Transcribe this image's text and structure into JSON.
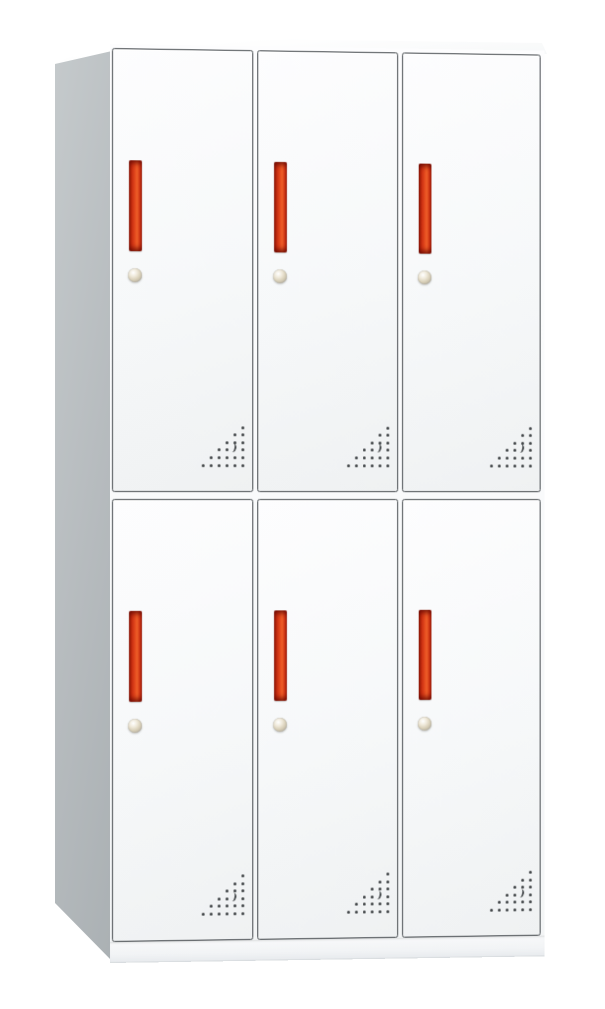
{
  "scene": {
    "description": "Product photograph of a white six-door steel locker cabinet on a plain white background, viewed slightly from the front-left so the grey left side panel and white top slab are visible.",
    "background_color": "#ffffff",
    "contains_text": false
  },
  "cabinet": {
    "type": "six-door-metal-locker",
    "rows": 2,
    "columns": 3,
    "door_count": 6,
    "doors": [
      {
        "id": "door-top-left",
        "row": 1,
        "column": 1
      },
      {
        "id": "door-top-center",
        "row": 1,
        "column": 2
      },
      {
        "id": "door-top-right",
        "row": 1,
        "column": 3
      },
      {
        "id": "door-bottom-left",
        "row": 2,
        "column": 1
      },
      {
        "id": "door-bottom-center",
        "row": 2,
        "column": 2
      },
      {
        "id": "door-bottom-right",
        "row": 2,
        "column": 3
      }
    ],
    "door_features": {
      "handle": {
        "shape": "vertical-recessed-bar",
        "color": "#e04518",
        "position": "upper-left-of-door"
      },
      "lock": {
        "shape": "round-cam-lock",
        "color": "#d9d0b9",
        "position": "below-handle"
      },
      "vent": {
        "shape": "triangular-dot-grid-with-crescent-cutout",
        "color": "#3d4144",
        "position": "bottom-right-of-door"
      }
    }
  },
  "vent_pattern": {
    "rows": 6,
    "dots_per_row": [
      1,
      2,
      3,
      4,
      5,
      6
    ],
    "alignment": "right-aligned-triangle",
    "spacing_x": 8,
    "spacing_y": 7.6,
    "dot_size": 3,
    "crescent": {
      "row_index": 3,
      "from_right": 1
    }
  },
  "colors": {
    "background": "#ffffff",
    "front_face": "#fafbfc",
    "door_face_light": "#fdfdfe",
    "door_face_dark": "#eff1f2",
    "door_border": "#43484c",
    "side_panel_light": "#c5cacc",
    "side_panel_dark": "#aab0b3",
    "top_surface_light": "#ffffff",
    "top_surface_dark": "#edf0f1",
    "handle_red_dark": "#8e1708",
    "handle_red_mid": "#c62c10",
    "handle_red_bright": "#ee5f28",
    "lock_highlight": "#ffffff",
    "lock_base": "#d9d0b9",
    "lock_shadow": "#b3ac9c",
    "vent_dot": "#3d4144",
    "base_edge": "#d8dcdf"
  }
}
